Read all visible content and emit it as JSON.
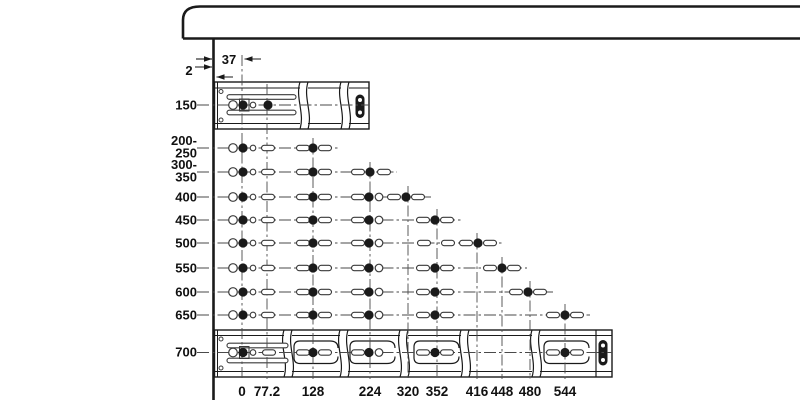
{
  "diagram": {
    "subject": "drawer-slide-mounting-hole-pattern",
    "canvas": {
      "w": 800,
      "h": 400,
      "bg": "#ffffff"
    },
    "palette": {
      "ink": "#1a1a1a",
      "line": "#4a4a4a",
      "hole": "#3a3a3a",
      "text": "#111111",
      "white": "#ffffff"
    },
    "hole_geometry": {
      "ring_r": 4.3,
      "dot_r": 4.6,
      "pin_r": 2.8,
      "oring_r": 3.8,
      "slot_w": 13,
      "slot_h": 5.4
    },
    "cabinet": {
      "left": 183,
      "top": 6.5,
      "bottom": 38.5,
      "corner_y": 20,
      "corner_x": 200,
      "right": 800,
      "wall_x": 213.5,
      "wall_y2": 400
    },
    "row_label_x": 197,
    "row_line_x1": 197,
    "col_label_y": 396,
    "col_bottom": 379,
    "annotations": [
      {
        "text": "37",
        "tx": 229,
        "ty": 64,
        "arrows": [
          {
            "x1": 196,
            "x2": 212,
            "y": 59,
            "head": "right"
          },
          {
            "x1": 244.5,
            "x2": 261,
            "y": 59,
            "head": "left"
          }
        ]
      },
      {
        "text": "2",
        "tx": 189,
        "ty": 75,
        "arrows": [
          {
            "x1": 195,
            "x2": 212,
            "y": 67,
            "head": "right"
          },
          {
            "x1": 216.5,
            "x2": 233,
            "y": 77,
            "head": "left"
          }
        ]
      }
    ],
    "columns": [
      {
        "label": "0",
        "x": 242,
        "top": 55
      },
      {
        "label": "77.2",
        "x": 267,
        "top": 84
      },
      {
        "label": "128",
        "x": 313,
        "top": 138
      },
      {
        "label": "224",
        "x": 370,
        "top": 162
      },
      {
        "label": "320",
        "x": 408,
        "top": 186
      },
      {
        "label": "352",
        "x": 437,
        "top": 209
      },
      {
        "label": "416",
        "x": 477,
        "top": 233
      },
      {
        "label": "448",
        "x": 502,
        "top": 257
      },
      {
        "label": "480",
        "x": 530,
        "top": 281
      },
      {
        "label": "544",
        "x": 565,
        "top": 304
      }
    ],
    "rows": [
      {
        "id": "150",
        "y": 105,
        "x_end": 369,
        "labels": [
          {
            "t": "150",
            "y": 109.5
          }
        ],
        "holes": [
          {
            "x": 233,
            "t": "ring"
          },
          {
            "x": 243,
            "t": "dot"
          },
          {
            "x": 253,
            "t": "pin"
          },
          {
            "x": 268,
            "t": "dot"
          }
        ]
      },
      {
        "id": "200-250",
        "y": 148,
        "x_end": 338,
        "labels": [
          {
            "t": "200-",
            "y": 145
          },
          {
            "t": "250",
            "y": 157.5
          }
        ],
        "holes": [
          {
            "x": 233,
            "t": "ring"
          },
          {
            "x": 243,
            "t": "dot"
          },
          {
            "x": 253,
            "t": "pin"
          },
          {
            "x": 268,
            "t": "slot"
          },
          {
            "x": 303,
            "t": "slot"
          },
          {
            "x": 313,
            "t": "dot"
          },
          {
            "x": 325,
            "t": "slot"
          }
        ]
      },
      {
        "id": "300-350",
        "y": 172,
        "x_end": 397,
        "labels": [
          {
            "t": "300-",
            "y": 169
          },
          {
            "t": "350",
            "y": 181.5
          }
        ],
        "holes": [
          {
            "x": 233,
            "t": "ring"
          },
          {
            "x": 243,
            "t": "dot"
          },
          {
            "x": 253,
            "t": "pin"
          },
          {
            "x": 268,
            "t": "slot"
          },
          {
            "x": 303,
            "t": "slot"
          },
          {
            "x": 313,
            "t": "dot"
          },
          {
            "x": 325,
            "t": "slot"
          },
          {
            "x": 358,
            "t": "slot"
          },
          {
            "x": 370,
            "t": "dot"
          },
          {
            "x": 384,
            "t": "slot"
          }
        ]
      },
      {
        "id": "400",
        "y": 197,
        "x_end": 431,
        "labels": [
          {
            "t": "400",
            "y": 201.5
          }
        ],
        "holes": [
          {
            "x": 233,
            "t": "ring"
          },
          {
            "x": 243,
            "t": "dot"
          },
          {
            "x": 253,
            "t": "pin"
          },
          {
            "x": 268,
            "t": "slot"
          },
          {
            "x": 303,
            "t": "slot"
          },
          {
            "x": 313,
            "t": "dot"
          },
          {
            "x": 325,
            "t": "slot"
          },
          {
            "x": 358,
            "t": "slot"
          },
          {
            "x": 369,
            "t": "dot"
          },
          {
            "x": 379,
            "t": "oring"
          },
          {
            "x": 394,
            "t": "slot"
          },
          {
            "x": 406,
            "t": "dot"
          },
          {
            "x": 418,
            "t": "slot"
          }
        ]
      },
      {
        "id": "450",
        "y": 220,
        "x_end": 461,
        "labels": [
          {
            "t": "450",
            "y": 224.5
          }
        ],
        "holes": [
          {
            "x": 233,
            "t": "ring"
          },
          {
            "x": 243,
            "t": "dot"
          },
          {
            "x": 253,
            "t": "pin"
          },
          {
            "x": 268,
            "t": "slot"
          },
          {
            "x": 303,
            "t": "slot"
          },
          {
            "x": 313,
            "t": "dot"
          },
          {
            "x": 325,
            "t": "slot"
          },
          {
            "x": 358,
            "t": "slot"
          },
          {
            "x": 369,
            "t": "dot"
          },
          {
            "x": 379,
            "t": "oring"
          },
          {
            "x": 423,
            "t": "slot"
          },
          {
            "x": 435,
            "t": "dot"
          },
          {
            "x": 447,
            "t": "slot"
          }
        ]
      },
      {
        "id": "500",
        "y": 243,
        "x_end": 503,
        "labels": [
          {
            "t": "500",
            "y": 247.5
          }
        ],
        "holes": [
          {
            "x": 233,
            "t": "ring"
          },
          {
            "x": 243,
            "t": "dot"
          },
          {
            "x": 253,
            "t": "pin"
          },
          {
            "x": 268,
            "t": "slot"
          },
          {
            "x": 303,
            "t": "slot"
          },
          {
            "x": 313,
            "t": "dot"
          },
          {
            "x": 325,
            "t": "slot"
          },
          {
            "x": 358,
            "t": "slot"
          },
          {
            "x": 369,
            "t": "dot"
          },
          {
            "x": 379,
            "t": "oring"
          },
          {
            "x": 424,
            "t": "slot"
          },
          {
            "x": 448,
            "t": "slot"
          },
          {
            "x": 466,
            "t": "slot"
          },
          {
            "x": 478,
            "t": "dot"
          },
          {
            "x": 490,
            "t": "slot"
          }
        ]
      },
      {
        "id": "550",
        "y": 268,
        "x_end": 527,
        "labels": [
          {
            "t": "550",
            "y": 272.5
          }
        ],
        "holes": [
          {
            "x": 233,
            "t": "ring"
          },
          {
            "x": 243,
            "t": "dot"
          },
          {
            "x": 253,
            "t": "pin"
          },
          {
            "x": 268,
            "t": "slot"
          },
          {
            "x": 303,
            "t": "slot"
          },
          {
            "x": 313,
            "t": "dot"
          },
          {
            "x": 325,
            "t": "slot"
          },
          {
            "x": 358,
            "t": "slot"
          },
          {
            "x": 369,
            "t": "dot"
          },
          {
            "x": 379,
            "t": "oring"
          },
          {
            "x": 423,
            "t": "slot"
          },
          {
            "x": 435,
            "t": "dot"
          },
          {
            "x": 447,
            "t": "slot"
          },
          {
            "x": 490,
            "t": "slot"
          },
          {
            "x": 502,
            "t": "dot"
          },
          {
            "x": 514,
            "t": "slot"
          }
        ]
      },
      {
        "id": "600",
        "y": 292,
        "x_end": 553,
        "labels": [
          {
            "t": "600",
            "y": 296.5
          }
        ],
        "holes": [
          {
            "x": 233,
            "t": "ring"
          },
          {
            "x": 243,
            "t": "dot"
          },
          {
            "x": 253,
            "t": "pin"
          },
          {
            "x": 268,
            "t": "slot"
          },
          {
            "x": 303,
            "t": "slot"
          },
          {
            "x": 313,
            "t": "dot"
          },
          {
            "x": 325,
            "t": "slot"
          },
          {
            "x": 358,
            "t": "slot"
          },
          {
            "x": 369,
            "t": "dot"
          },
          {
            "x": 379,
            "t": "oring"
          },
          {
            "x": 423,
            "t": "slot"
          },
          {
            "x": 435,
            "t": "dot"
          },
          {
            "x": 447,
            "t": "slot"
          },
          {
            "x": 516,
            "t": "slot"
          },
          {
            "x": 528,
            "t": "dot"
          },
          {
            "x": 540,
            "t": "slot"
          }
        ]
      },
      {
        "id": "650",
        "y": 315,
        "x_end": 590,
        "labels": [
          {
            "t": "650",
            "y": 319.5
          }
        ],
        "holes": [
          {
            "x": 233,
            "t": "ring"
          },
          {
            "x": 243,
            "t": "dot"
          },
          {
            "x": 253,
            "t": "pin"
          },
          {
            "x": 268,
            "t": "slot"
          },
          {
            "x": 303,
            "t": "slot"
          },
          {
            "x": 313,
            "t": "dot"
          },
          {
            "x": 325,
            "t": "slot"
          },
          {
            "x": 358,
            "t": "slot"
          },
          {
            "x": 369,
            "t": "dot"
          },
          {
            "x": 379,
            "t": "oring"
          },
          {
            "x": 423,
            "t": "slot"
          },
          {
            "x": 435,
            "t": "dot"
          },
          {
            "x": 447,
            "t": "slot"
          },
          {
            "x": 553,
            "t": "slot"
          },
          {
            "x": 565,
            "t": "dot"
          },
          {
            "x": 577,
            "t": "slot"
          }
        ]
      },
      {
        "id": "700",
        "y": 352.5,
        "x_end": 612,
        "labels": [
          {
            "t": "700",
            "y": 356.5
          }
        ],
        "holes": [
          {
            "x": 233,
            "t": "ring"
          },
          {
            "x": 243,
            "t": "dot"
          },
          {
            "x": 253,
            "t": "pin"
          },
          {
            "x": 269,
            "t": "slot"
          },
          {
            "x": 303,
            "t": "slot"
          },
          {
            "x": 313,
            "t": "dot"
          },
          {
            "x": 325,
            "t": "slot"
          },
          {
            "x": 358,
            "t": "slot"
          },
          {
            "x": 369,
            "t": "dot"
          },
          {
            "x": 379,
            "t": "oring"
          },
          {
            "x": 423,
            "t": "slot"
          },
          {
            "x": 435,
            "t": "dot"
          },
          {
            "x": 447,
            "t": "slot"
          },
          {
            "x": 553,
            "t": "slot"
          },
          {
            "x": 565,
            "t": "dot"
          },
          {
            "x": 577,
            "t": "slot"
          }
        ]
      }
    ],
    "rails": [
      {
        "name": "slide-rail-top",
        "x1": 214.5,
        "y1": 82,
        "x2": 369,
        "y2": 129,
        "inner_left": 217.5,
        "flanges": [
          88,
          123.5
        ],
        "screws": [
          [
            221,
            91.5
          ],
          [
            221,
            120
          ]
        ],
        "long_slots": [
          {
            "x1": 227,
            "x2": 296,
            "cy": 97
          },
          {
            "x1": 227,
            "x2": 296,
            "cy": 112.5
          }
        ],
        "clip": [
          239.5,
          99,
          9.5,
          12
        ],
        "breaks": [
          [
            300,
            308
          ],
          [
            341,
            349
          ]
        ],
        "windows": [],
        "window_y1": 0,
        "window_y2": 0,
        "cap": {
          "cx": 360,
          "y1": 94.5,
          "y2": 118
        },
        "end_line": null
      },
      {
        "name": "slide-rail-bottom",
        "x1": 214.5,
        "y1": 330,
        "x2": 612,
        "y2": 377,
        "inner_left": 217.5,
        "flanges": [
          335.5,
          371.5
        ],
        "screws": [
          [
            221,
            339
          ],
          [
            221,
            368
          ]
        ],
        "long_slots": [
          {
            "x1": 227,
            "x2": 288,
            "cy": 345.5
          },
          {
            "x1": 227,
            "x2": 288,
            "cy": 360.5
          }
        ],
        "clip": [
          239.5,
          346.5,
          9.5,
          12
        ],
        "breaks": [
          [
            284,
            292
          ],
          [
            340,
            348
          ],
          [
            400,
            408
          ],
          [
            461,
            469
          ],
          [
            532,
            540
          ]
        ],
        "windows": [
          {
            "x1": 294,
            "x2": 336
          },
          {
            "x1": 350,
            "x2": 393
          },
          {
            "x1": 414,
            "x2": 457
          },
          {
            "x1": 544,
            "x2": 587
          }
        ],
        "window_y1": 341,
        "window_y2": 363.5,
        "cap": {
          "cx": 603,
          "y1": 340,
          "y2": 365.5
        },
        "end_line": 596
      }
    ]
  }
}
